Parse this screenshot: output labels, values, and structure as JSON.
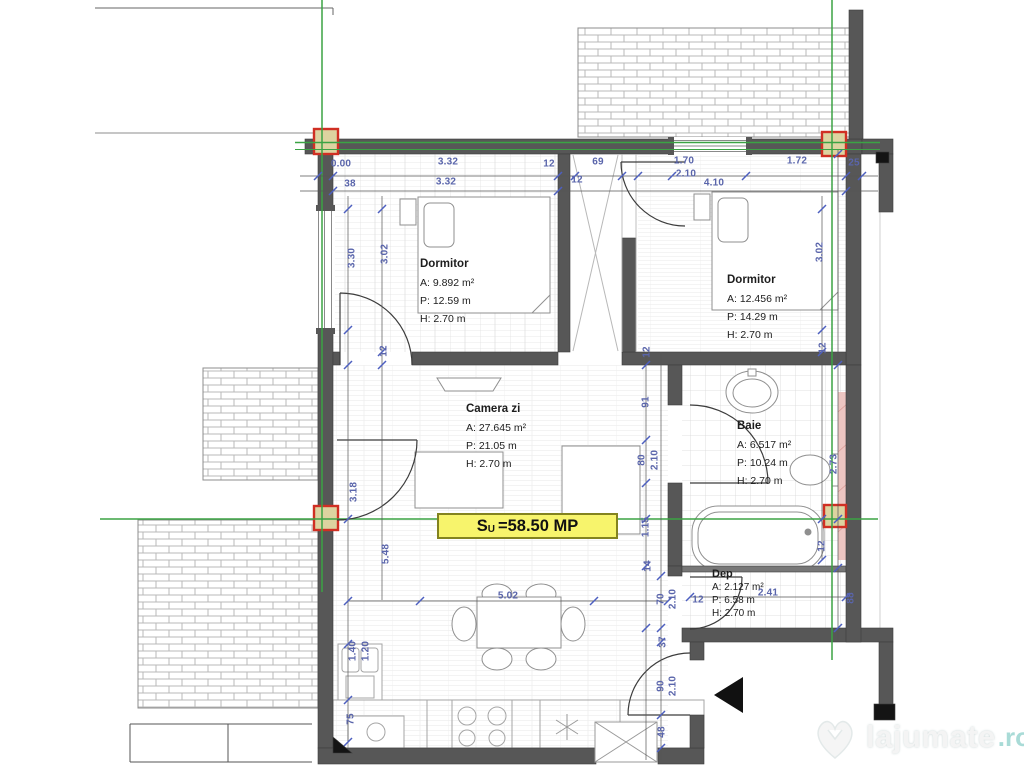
{
  "area_label": {
    "prefix": "S",
    "sub": "U",
    "value": "=58.50 MP"
  },
  "rooms": [
    {
      "name": "Dormitor",
      "a": "A: 9.892 m²",
      "p": "P: 12.59 m",
      "h": "H:  2.70 m",
      "x": 420,
      "y": 258,
      "small": false
    },
    {
      "name": "Dormitor",
      "a": "A: 12.456 m²",
      "p": "P: 14.29 m",
      "h": "H:  2.70 m",
      "x": 727,
      "y": 274,
      "small": false
    },
    {
      "name": "Camera zi",
      "a": "A: 27.645 m²",
      "p": "P: 21.05 m",
      "h": "H:  2.70 m",
      "x": 466,
      "y": 403,
      "small": false
    },
    {
      "name": "Baie",
      "a": "A: 6.517 m²",
      "p": "P: 10.24 m",
      "h": "H:  2.70 m",
      "x": 737,
      "y": 420,
      "small": false
    },
    {
      "name": "Dep",
      "a": "A: 2.127 m²",
      "p": "P: 6.58 m",
      "h": "H: 2.70 m",
      "x": 712,
      "y": 568,
      "small": true
    }
  ],
  "dimensions": [
    {
      "t": "0.00",
      "x": 341,
      "y": 164,
      "r": 0
    },
    {
      "t": "3.32",
      "x": 448,
      "y": 162,
      "r": 0
    },
    {
      "t": "12",
      "x": 549,
      "y": 164,
      "r": 0
    },
    {
      "t": "69",
      "x": 598,
      "y": 162,
      "r": 0
    },
    {
      "t": "1.70",
      "x": 684,
      "y": 161,
      "r": 0
    },
    {
      "t": "2.10",
      "x": 686,
      "y": 174,
      "r": 0
    },
    {
      "t": "1.72",
      "x": 797,
      "y": 161,
      "r": 0
    },
    {
      "t": "25",
      "x": 854,
      "y": 163,
      "r": 0
    },
    {
      "t": "38",
      "x": 350,
      "y": 184,
      "r": 0
    },
    {
      "t": "3.32",
      "x": 446,
      "y": 182,
      "r": 0
    },
    {
      "t": "12",
      "x": 577,
      "y": 180,
      "r": 0
    },
    {
      "t": "4.10",
      "x": 714,
      "y": 183,
      "r": 0
    },
    {
      "t": "3.30",
      "x": 352,
      "y": 258,
      "r": 1
    },
    {
      "t": "3.02",
      "x": 385,
      "y": 254,
      "r": 1
    },
    {
      "t": "12",
      "x": 384,
      "y": 351,
      "r": 1
    },
    {
      "t": "3.02",
      "x": 820,
      "y": 252,
      "r": 1
    },
    {
      "t": "12",
      "x": 823,
      "y": 348,
      "r": 1
    },
    {
      "t": "3.18",
      "x": 354,
      "y": 492,
      "r": 1
    },
    {
      "t": "5.48",
      "x": 386,
      "y": 554,
      "r": 1
    },
    {
      "t": "12",
      "x": 647,
      "y": 352,
      "r": 1
    },
    {
      "t": "91",
      "x": 646,
      "y": 402,
      "r": 1
    },
    {
      "t": "80",
      "x": 642,
      "y": 460,
      "r": 1
    },
    {
      "t": "2.10",
      "x": 655,
      "y": 460,
      "r": 1
    },
    {
      "t": "1.15",
      "x": 646,
      "y": 527,
      "r": 1
    },
    {
      "t": "14",
      "x": 648,
      "y": 566,
      "r": 1
    },
    {
      "t": "70",
      "x": 661,
      "y": 599,
      "r": 1
    },
    {
      "t": "2.10",
      "x": 673,
      "y": 599,
      "r": 1
    },
    {
      "t": "37",
      "x": 663,
      "y": 642,
      "r": 1
    },
    {
      "t": "90",
      "x": 661,
      "y": 686,
      "r": 1
    },
    {
      "t": "2.10",
      "x": 673,
      "y": 686,
      "r": 1
    },
    {
      "t": "48",
      "x": 662,
      "y": 732,
      "r": 1
    },
    {
      "t": "2.73",
      "x": 834,
      "y": 464,
      "r": 1
    },
    {
      "t": "12",
      "x": 822,
      "y": 546,
      "r": 1
    },
    {
      "t": "88",
      "x": 851,
      "y": 598,
      "r": 1
    },
    {
      "t": "2.41",
      "x": 768,
      "y": 593,
      "r": 0
    },
    {
      "t": "12",
      "x": 698,
      "y": 600,
      "r": 0
    },
    {
      "t": "5.02",
      "x": 508,
      "y": 596,
      "r": 0
    },
    {
      "t": "1.40",
      "x": 353,
      "y": 651,
      "r": 1
    },
    {
      "t": "1.20",
      "x": 366,
      "y": 651,
      "r": 1
    },
    {
      "t": "75",
      "x": 351,
      "y": 719,
      "r": 1
    }
  ],
  "watermark": {
    "name": "lajumate",
    "tld": ".ro"
  },
  "colors": {
    "axis_green": "#3ba344",
    "dim_blue": "#5a65ab",
    "wall_gray": "#575757",
    "badge_yellow": "#f7f46c",
    "marker_red": "#d02f23",
    "hatch_pink": "#edc6c2"
  }
}
